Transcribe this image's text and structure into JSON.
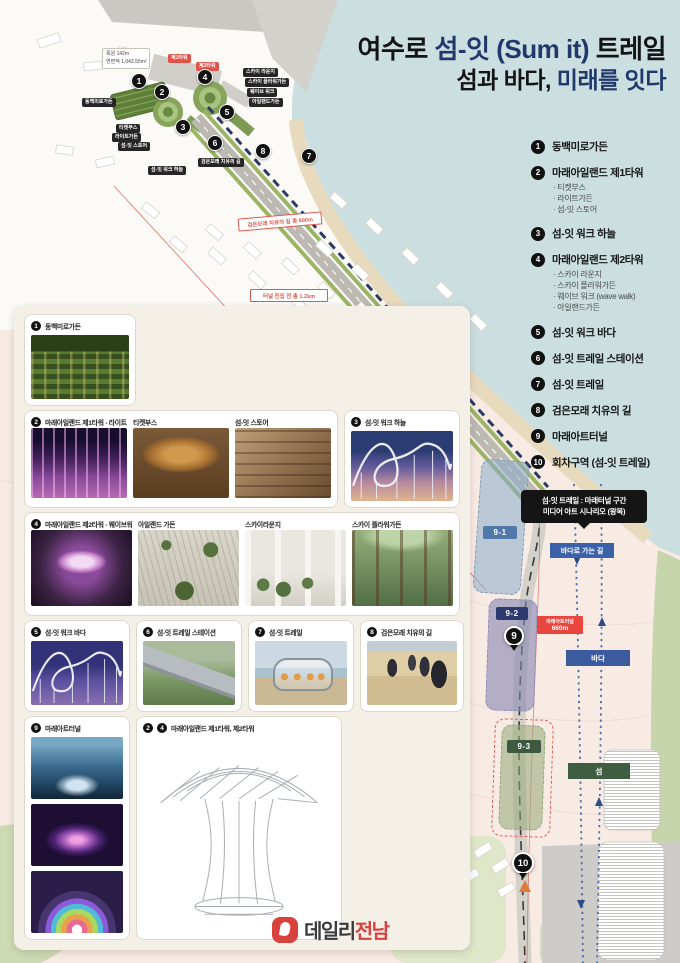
{
  "title": {
    "l1a": "여수로 ",
    "l1b": "섬-잇 (Sum it)",
    "l1c": " 트레일",
    "l2a": "섬과 바다, ",
    "l2b": "미래를 잇다"
  },
  "legend": {
    "items": [
      {
        "num": "1",
        "label": "동백미로가든"
      },
      {
        "num": "2",
        "label": "마래아일랜드 제1타워",
        "subs": [
          "· 티켓부스",
          "· 라이트가든",
          "· 섬-잇 스토어"
        ]
      },
      {
        "num": "3",
        "label": "섬-잇 워크 하늘"
      },
      {
        "num": "4",
        "label": "마래아일랜드 제2타워",
        "subs": [
          "· 스카이 라운지",
          "· 스카이 플라워가든",
          "· 웨이브 워크 (wave walk)",
          "· 아일랜드가든"
        ]
      },
      {
        "num": "5",
        "label": "섬-잇 워크 바다"
      },
      {
        "num": "6",
        "label": "섬-잇 트레일 스테이션"
      },
      {
        "num": "7",
        "label": "섬-잇 트레일"
      },
      {
        "num": "8",
        "label": "검은모래 치유의 길"
      },
      {
        "num": "9",
        "label": "마래아트터널"
      },
      {
        "num": "10",
        "label": "회차구역 (섬-잇 트레일)"
      }
    ]
  },
  "map": {
    "markers": [
      "1",
      "2",
      "3",
      "4",
      "5",
      "6",
      "7",
      "8"
    ],
    "pin9": "9",
    "pin10": "10",
    "segments": {
      "s1": "9-1",
      "s2": "9-2",
      "s3": "9-3"
    },
    "labels": {
      "beach": "검은모래 치유의 길 총 800m",
      "tunnel_entry": "터널 진입 전 총 1.2km",
      "d400": "400m",
      "tunnel_name": "마래아트터널",
      "tunnel_len": "660m",
      "scenario1": "섬-잇 트레일 : 마래터널 구간",
      "scenario2": "미디어 아트 시나리오 (왕복)",
      "to_sea": "바다로 가는 길",
      "sea": "바다",
      "island": "섬"
    },
    "info": {
      "line1": "폭원 142m",
      "line2": "연면적 1,043.55m²"
    },
    "callouts": [
      {
        "text": "동백미로가든"
      },
      {
        "text": "티켓부스"
      },
      {
        "text": "라이트가든"
      },
      {
        "text": "섬-잇 스토어"
      },
      {
        "text": "스카이 라운지"
      },
      {
        "text": "스카이 플라워가든"
      },
      {
        "text": "웨이브 워크"
      },
      {
        "text": "아일랜드가든"
      },
      {
        "text": "섬-잇 워크 하늘"
      },
      {
        "text": "검은모래 치유의 길"
      },
      {
        "text": "제1타워"
      },
      {
        "text": "제2타워"
      }
    ]
  },
  "cards": {
    "c1": {
      "num": "1",
      "label": "동백미로가든"
    },
    "c2": {
      "num": "2",
      "cols": [
        "마래아일랜드 제1타워 - 라이트가든",
        "티켓부스",
        "섬-잇 스토어"
      ]
    },
    "c3": {
      "num": "3",
      "label": "섬-잇 워크 하늘"
    },
    "c4": {
      "num": "4",
      "cols": [
        "마래아일랜드 제2타워 - 웨이브워크",
        "아일랜드 가든",
        "스카이라운지",
        "스카이 플라워가든"
      ]
    },
    "c5": {
      "num": "5",
      "label": "섬-잇 워크 바다"
    },
    "c6": {
      "num": "6",
      "label": "섬-잇 트레일 스테이션"
    },
    "c7": {
      "num": "7",
      "label": "섬-잇 트레일"
    },
    "c8": {
      "num": "8",
      "label": "검은모래 치유의 길"
    },
    "c9": {
      "num": "9",
      "label": "마래아트터널"
    },
    "c24": {
      "numA": "2",
      "numB": "4",
      "label": "마래아일랜드 제1타워, 제2타워"
    }
  },
  "footer": {
    "brand1": "데일리",
    "brand2": "전남"
  }
}
